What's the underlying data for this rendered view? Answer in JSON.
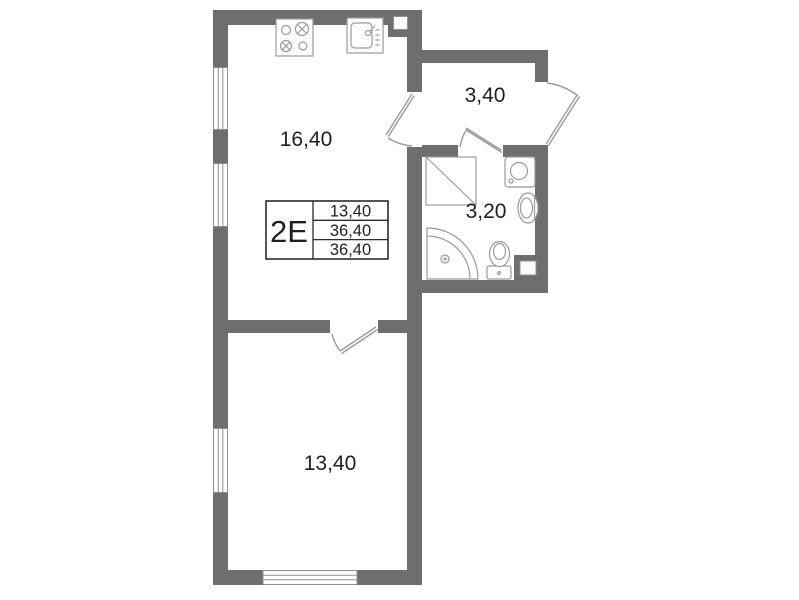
{
  "apartment": {
    "type_label": "2E",
    "info_table": {
      "rows": [
        "13,40",
        "36,40",
        "36,40"
      ]
    },
    "rooms": {
      "kitchen_living": {
        "area": "16,40"
      },
      "hallway": {
        "area": "3,40"
      },
      "bathroom": {
        "area": "3,20"
      },
      "bedroom": {
        "area": "13,40"
      }
    },
    "colors": {
      "wall": "#6e6e6e",
      "fixture_line": "#9a9a9a",
      "window_line": "#8f8f8f",
      "text": "#1f1f1f",
      "table_border": "#2b2b2b",
      "background": "#ffffff"
    },
    "icons": [
      "stove-icon",
      "kitchen-sink-icon",
      "shower-box-icon",
      "washing-machine-icon",
      "wash-basin-icon",
      "toilet-icon",
      "corner-shower-icon",
      "entrance-door-icon",
      "kitchen-door-icon",
      "bathroom-door-icon",
      "bedroom-door-icon",
      "window-icon"
    ]
  }
}
